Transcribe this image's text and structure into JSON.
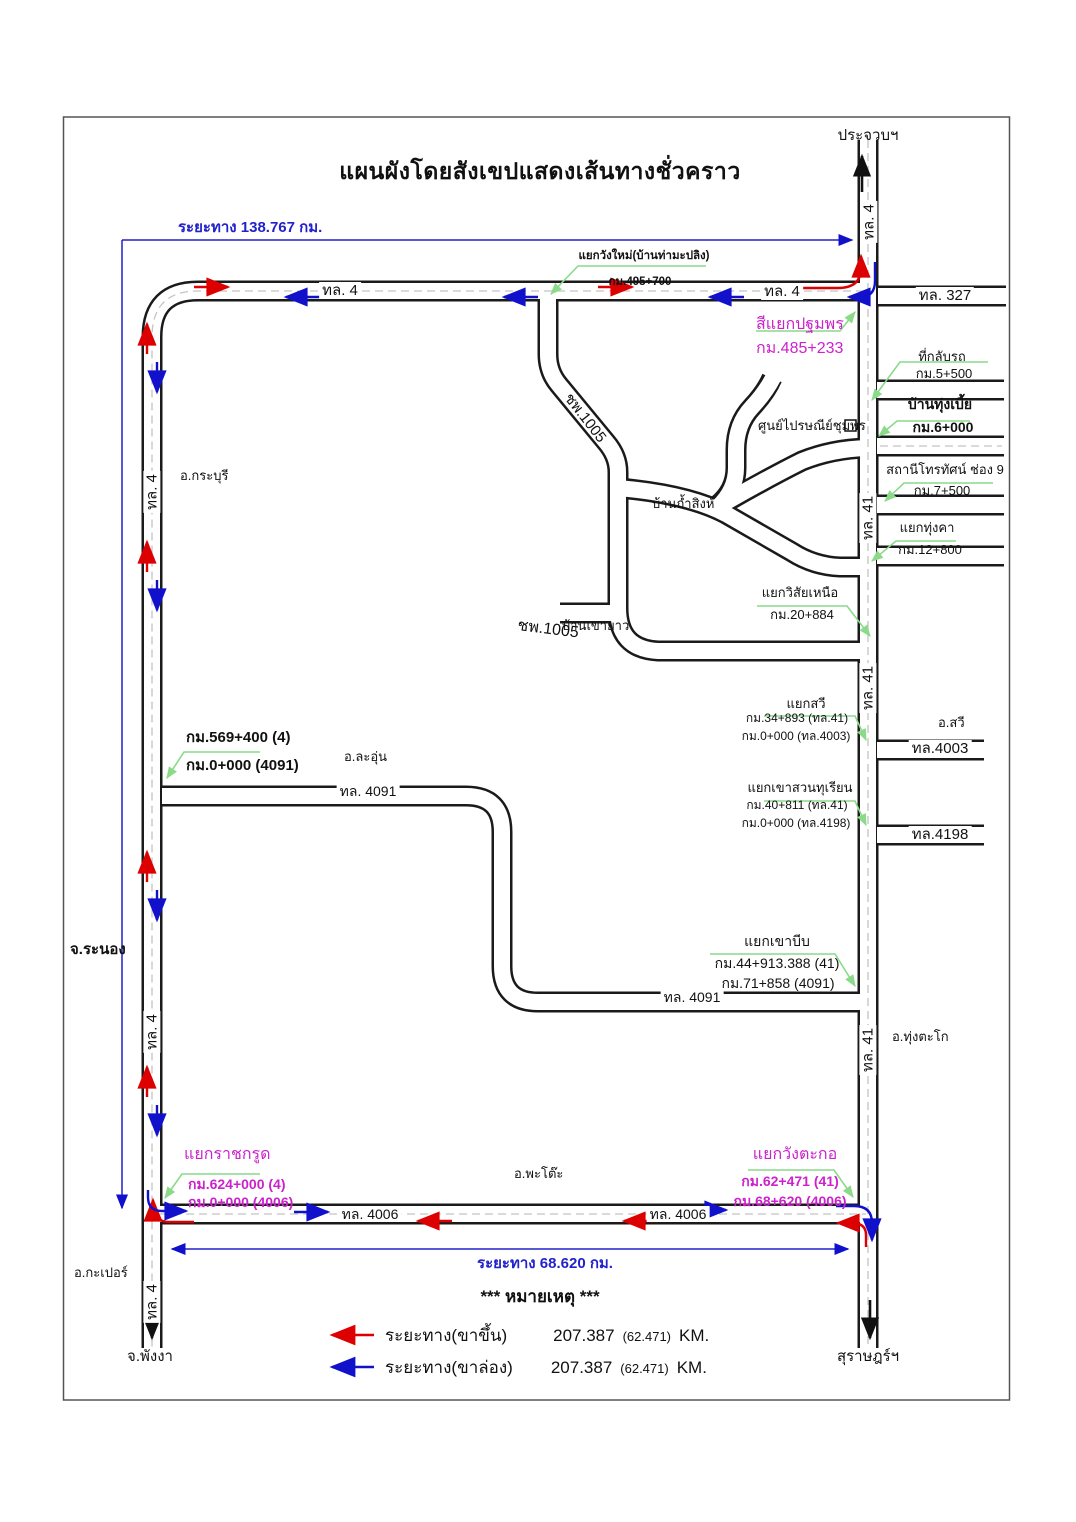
{
  "title": "แผนผังโดยสังเขปแสดงเส้นทางชั่วคราว",
  "measures": {
    "top": "ระยะทาง 138.767 กม.",
    "bottom": "ระยะทาง 68.620 กม."
  },
  "destinations": {
    "north": "ประจวบฯ",
    "southwest": "จ.พังงา",
    "southeast": "สุราษฎร์ฯ"
  },
  "areas": {
    "kraburi": "อ.กระบุรี",
    "ranong": "จ.ระนอง",
    "la_un": "อ.ละอุ่น",
    "sawi": "อ.สวี",
    "thung_tako": "อ.ทุ่งตะโก",
    "phato": "อ.พะโต๊ะ",
    "kapoe": "อ.กะเปอร์"
  },
  "places": {
    "ban_tham_sing": "บ้านถ้ำสิงห์",
    "ban_khao_yao": "บ้านเขายาว",
    "chumphon_post": "ศูนย์ไปรษณีย์ชุมพร"
  },
  "roads": {
    "r4": "ทล. 4",
    "r327": "ทล. 327",
    "r41": "ทล. 41",
    "cp1005": "ชพ.1005",
    "r4091": "ทล. 4091",
    "r4003": "ทล.4003",
    "r4198": "ทล.4198",
    "r4006": "ทล. 4006"
  },
  "junctions": {
    "wangmai": {
      "name": "แยกวังใหม่(บ้านท่ามะปลิง)",
      "km": "กม.495+700"
    },
    "pathomphon": {
      "name": "สีแยกปฐมพร",
      "km": "กม.485+233"
    },
    "uturn": {
      "name": "ที่กลับรถ",
      "km": "กม.5+500"
    },
    "thungbia": {
      "name": "บ้านทุ่งเบี้ย",
      "km": "กม.6+000"
    },
    "tv9": {
      "name": "สถานีโทรทัศน์ ช่อง 9",
      "km": "กม.7+500"
    },
    "thungkha": {
      "name": "แยกทุ่งคา",
      "km": "กม.12+800"
    },
    "wisai": {
      "name": "แยกวิสัยเหนือ",
      "km": "กม.20+884"
    },
    "sawi": {
      "name": "แยกสวี",
      "km1": "กม.34+893 (ทล.41)",
      "km2": "กม.0+000 (ทล.4003)"
    },
    "khaosuan": {
      "name": "แยกเขาสวนทุเรียน",
      "km1": "กม.40+811 (ทล.41)",
      "km2": "กม.0+000 (ทล.4198)"
    },
    "khaobip": {
      "name": "แยกเขาบีบ",
      "km1": "กม.44+913.388 (41)",
      "km2": "กม.71+858 (4091)"
    },
    "km569": {
      "km1": "กม.569+400 (4)",
      "km2": "กม.0+000 (4091)"
    },
    "ratchakrut": {
      "name": "แยกราชกรูด",
      "km1": "กม.624+000 (4)",
      "km2": "กม.0+000 (4006)"
    },
    "wangtako": {
      "name": "แยกวังตะกอ",
      "km1": "กม.62+471 (41)",
      "km2": "กม.68+620 (4006)"
    }
  },
  "legend": {
    "header": "*** หมายเหตุ ***",
    "up": {
      "label": "ระยะทาง(ขาขึ้น)",
      "value": "207.387",
      "alt": "(62.471)",
      "unit": "KM."
    },
    "down": {
      "label": "ระยะทาง(ขาล่อง)",
      "value": "207.387",
      "alt": "(62.471)",
      "unit": "KM."
    }
  },
  "colors": {
    "route_up": "#dd0000",
    "route_down": "#1111cc",
    "leader_green": "#8ada8a",
    "junction_magenta": "#cc22cc",
    "measure_blue": "#2222cc",
    "road_casing": "#1a1a1a"
  }
}
